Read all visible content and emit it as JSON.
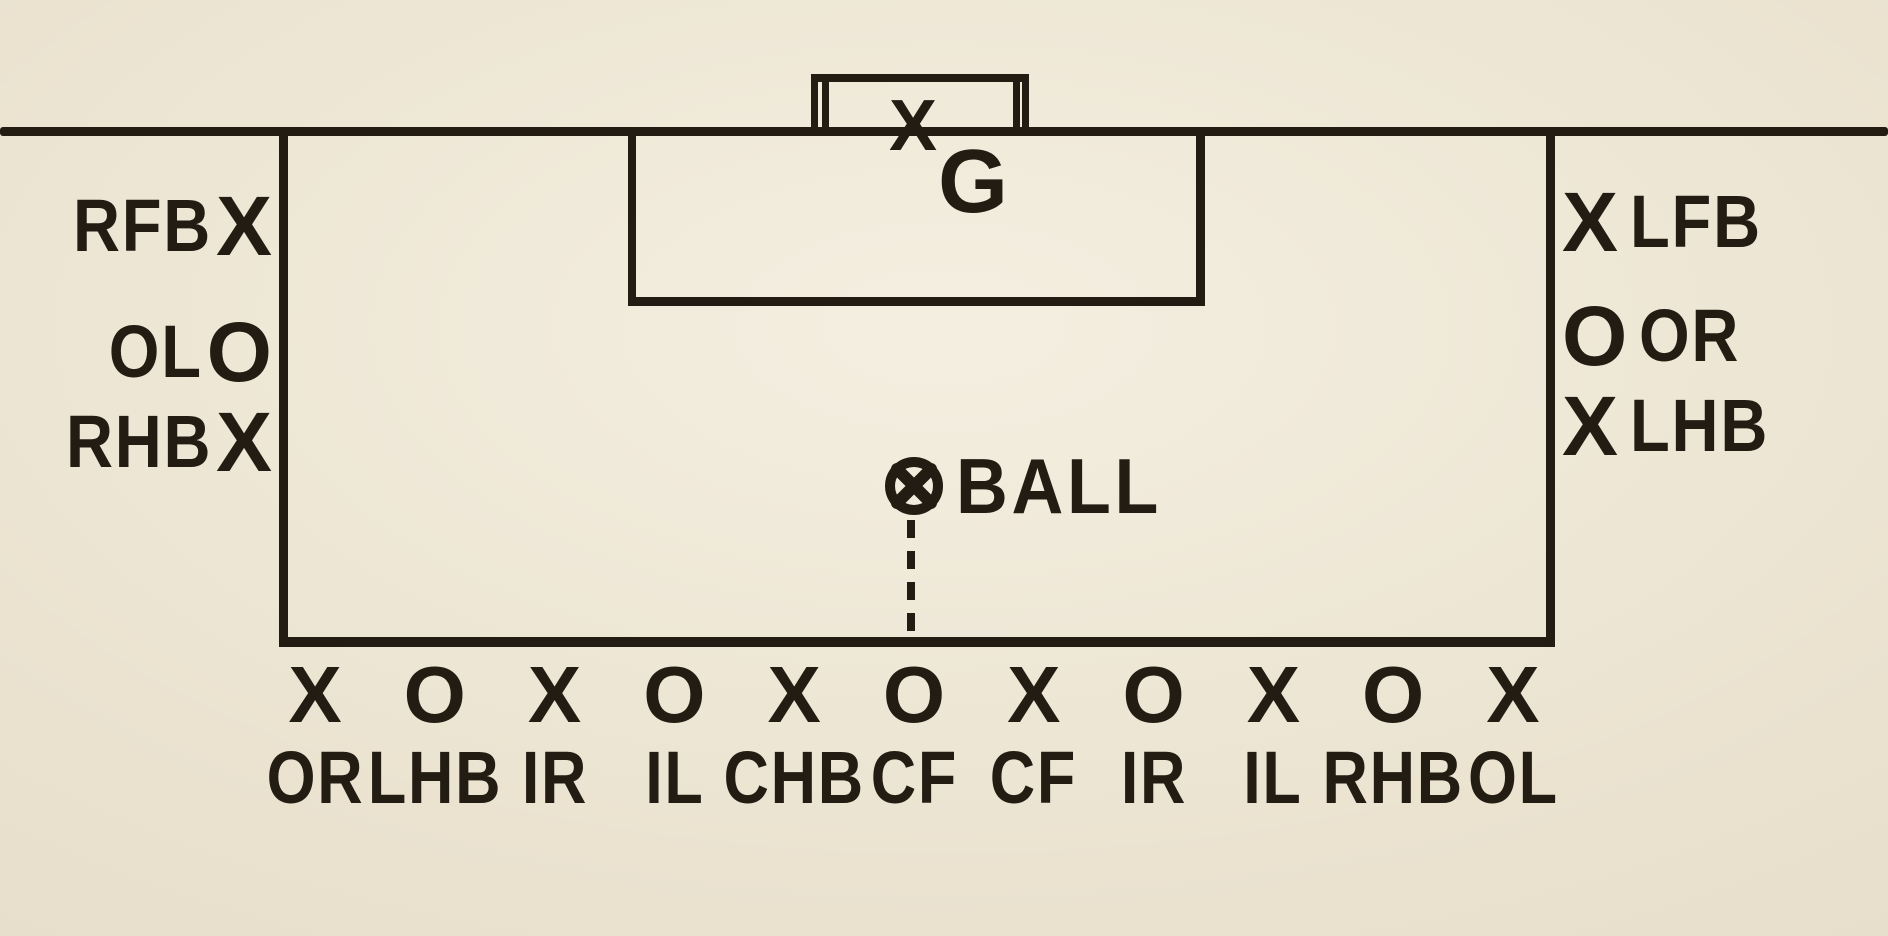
{
  "diagram": {
    "description": "Soccer tactics diagram: players massed on the goal line defending, drawn on cream book paper",
    "paper_color": "#ebe3d0",
    "ink_color": "#221c13",
    "goalkeeper": {
      "marker": "X",
      "label": "G"
    },
    "ball": {
      "icon": "crossed-circle",
      "label": "BALL"
    },
    "left_players": [
      {
        "label": "RFB",
        "marker": "X"
      },
      {
        "label": "OL",
        "marker": "O"
      },
      {
        "label": "RHB",
        "marker": "X"
      }
    ],
    "right_players": [
      {
        "marker": "X",
        "label": "LFB"
      },
      {
        "marker": "O",
        "label": "OR"
      },
      {
        "marker": "X",
        "label": "LHB"
      }
    ],
    "goal_line_players": [
      {
        "marker": "X",
        "label": "OR"
      },
      {
        "marker": "O",
        "label": "LHB"
      },
      {
        "marker": "X",
        "label": "IR"
      },
      {
        "marker": "O",
        "label": "IL"
      },
      {
        "marker": "X",
        "label": "CHB"
      },
      {
        "marker": "O",
        "label": "CF"
      },
      {
        "marker": "X",
        "label": "CF"
      },
      {
        "marker": "O",
        "label": "IR"
      },
      {
        "marker": "X",
        "label": "IL"
      },
      {
        "marker": "O",
        "label": "RHB"
      },
      {
        "marker": "X",
        "label": "OL"
      }
    ]
  }
}
